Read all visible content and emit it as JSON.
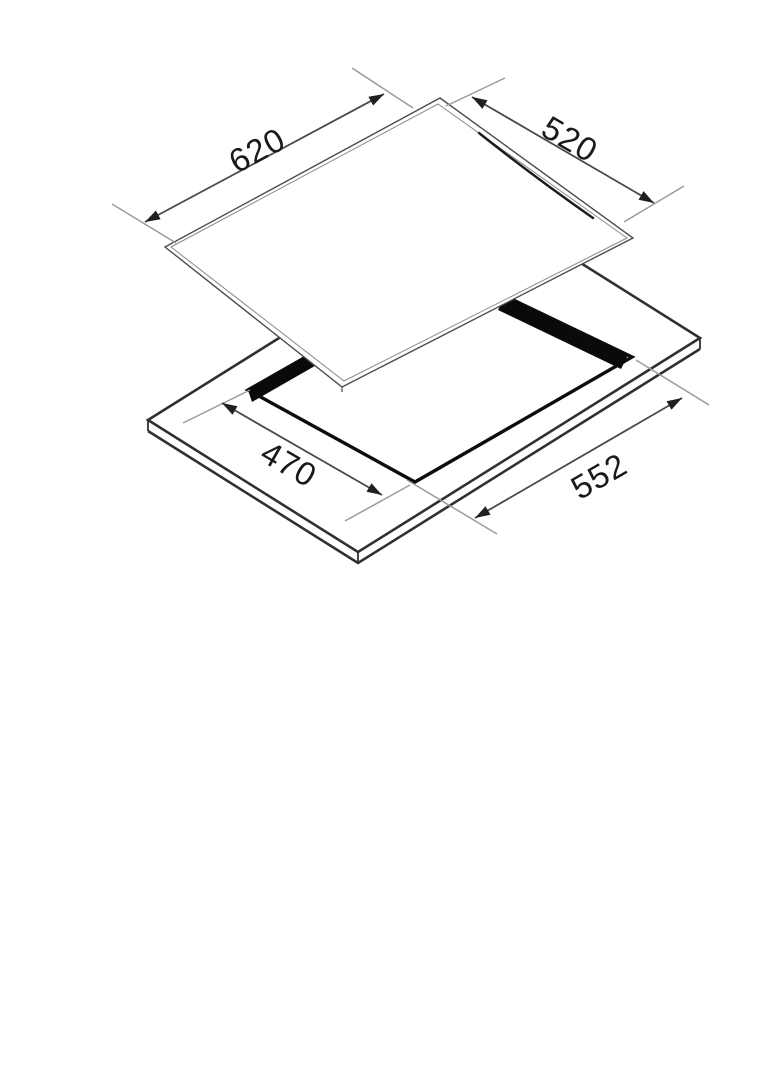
{
  "diagram": {
    "dimensions": {
      "glass_width": {
        "label": "620"
      },
      "glass_depth": {
        "label": "520"
      },
      "cutout_depth": {
        "label": "470"
      },
      "cutout_width": {
        "label": "552"
      }
    },
    "colors": {
      "background": "#ffffff",
      "ink": "#1a1a1a",
      "line_dark": "#0d0d0d",
      "line_medium": "#303030",
      "line_light": "#9b9b9b"
    }
  }
}
